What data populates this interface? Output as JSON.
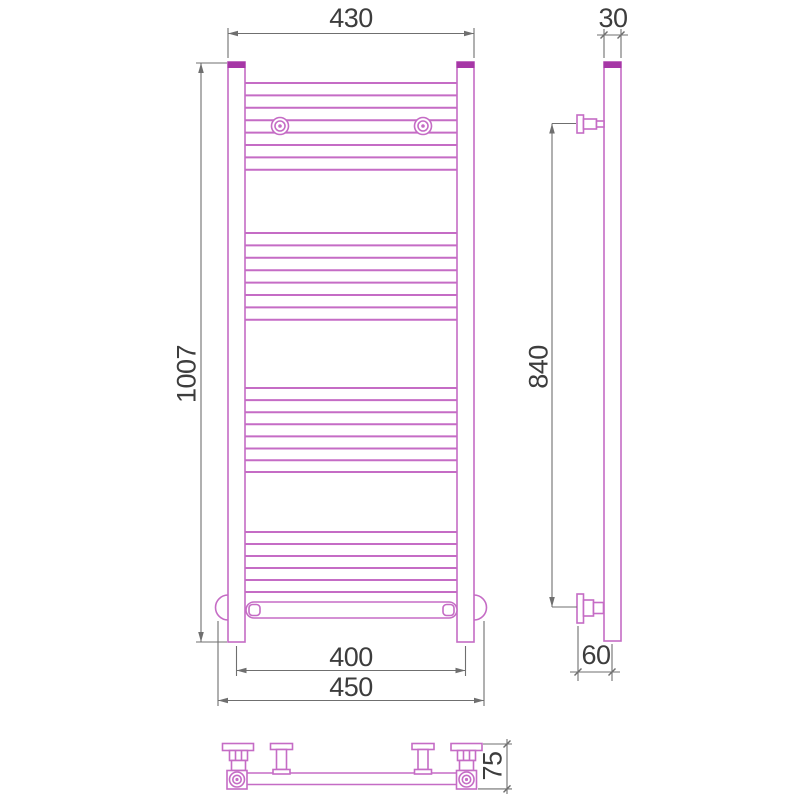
{
  "drawing": {
    "title": "towel-radiator-dimension-drawing",
    "front_view": {
      "width_top": "430",
      "height": "1007",
      "axis_spacing": "400",
      "base_width": "450"
    },
    "side_view": {
      "tube_depth": "30",
      "bracket_span": "840",
      "wall_offset": "60"
    },
    "bottom_view": {
      "valve_height": "75"
    }
  },
  "colors": {
    "pipe": "#c56cc5",
    "pipe_cap": "#a637a6",
    "dimension_line": "#6f6f6f",
    "dimension_text": "#3d3d3d"
  }
}
